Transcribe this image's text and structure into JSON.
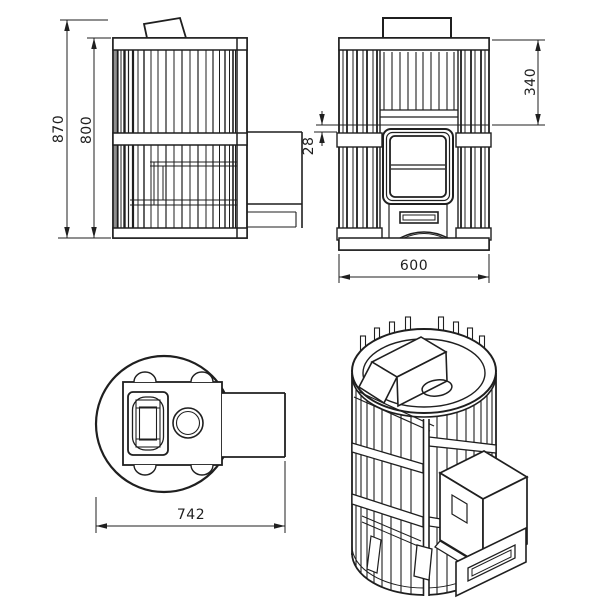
{
  "drawing": {
    "type": "technical-drawing-4-views",
    "subject": "cylindrical slatted sauna stove with firebox tunnel",
    "background_color": "#ffffff",
    "line_color": "#1f1f1f",
    "dims": {
      "overall_height": "870",
      "body_height": "800",
      "upper_section": "340",
      "shelf_gap": "28",
      "width": "600",
      "depth": "742"
    }
  }
}
